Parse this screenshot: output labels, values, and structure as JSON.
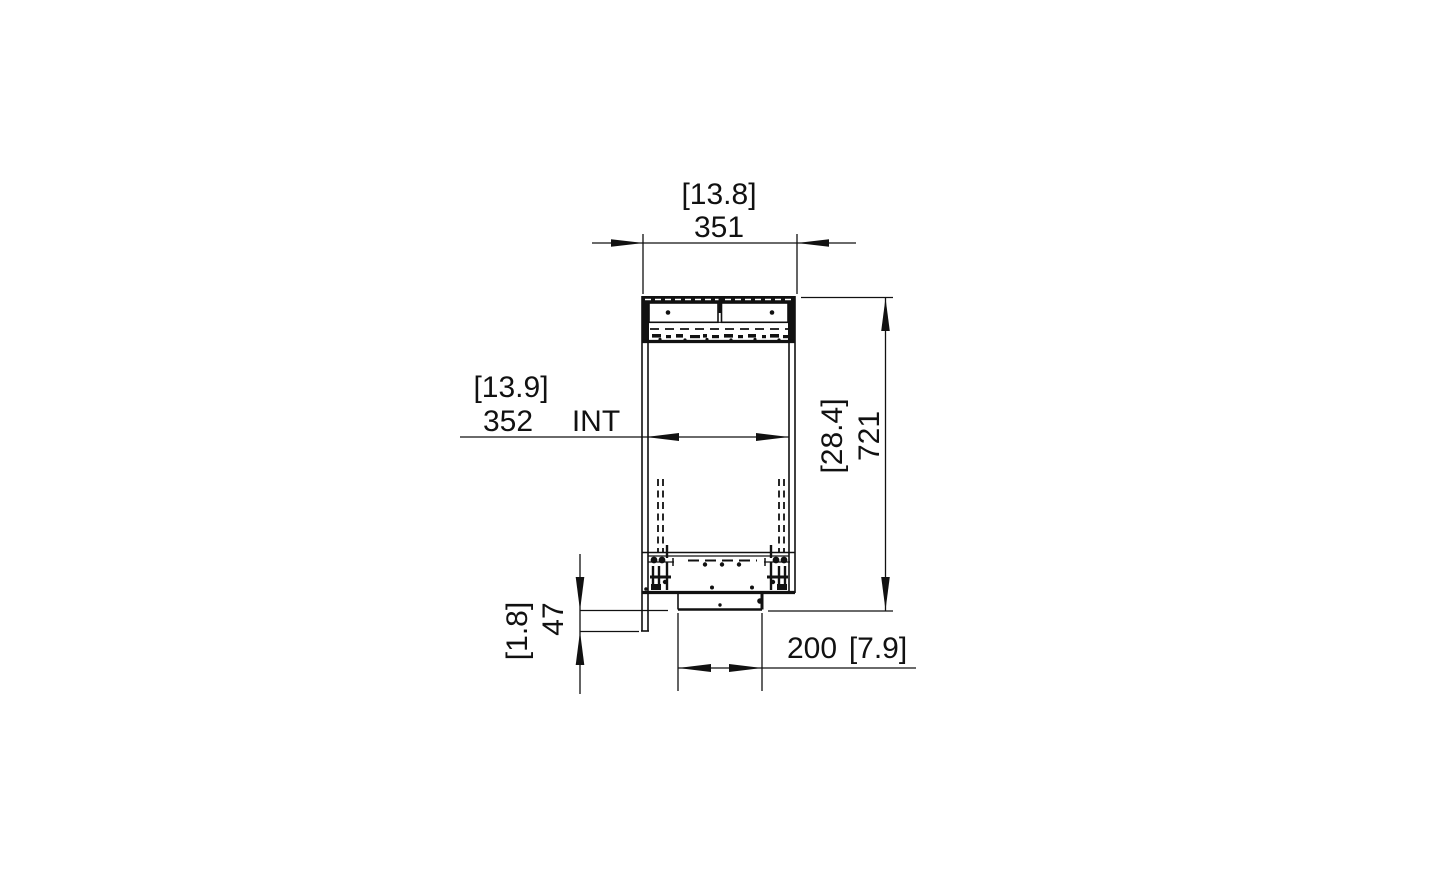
{
  "colors": {
    "line": "#111111",
    "background": "#ffffff"
  },
  "dimensions": {
    "top_width": {
      "imperial": "[13.8]",
      "metric": "351"
    },
    "internal_width": {
      "imperial": "[13.9]",
      "metric": "352",
      "suffix": "INT"
    },
    "overall_height": {
      "imperial": "[28.4]",
      "metric": "721"
    },
    "base_drop": {
      "imperial": "[1.8]",
      "metric": "47"
    },
    "base_width": {
      "metric": "200",
      "imperial": "[7.9]"
    }
  }
}
